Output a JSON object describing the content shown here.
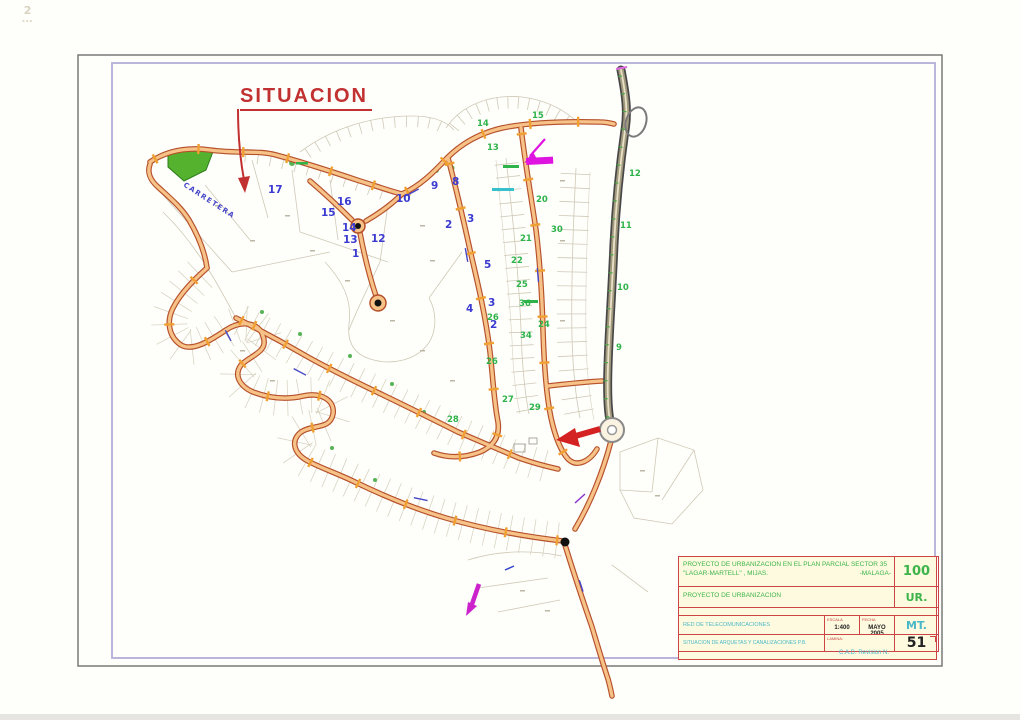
{
  "page": {
    "corner_mark": "2"
  },
  "situacion_label": "SITUACION",
  "map": {
    "road_name": "CARRETERA",
    "blue_labels": [
      {
        "t": "17",
        "x": 268,
        "y": 193
      },
      {
        "t": "16",
        "x": 337,
        "y": 205
      },
      {
        "t": "15",
        "x": 321,
        "y": 216
      },
      {
        "t": "14",
        "x": 342,
        "y": 231
      },
      {
        "t": "13",
        "x": 343,
        "y": 243
      },
      {
        "t": "12",
        "x": 371,
        "y": 242
      },
      {
        "t": "1",
        "x": 352,
        "y": 257
      },
      {
        "t": "10",
        "x": 396,
        "y": 202
      },
      {
        "t": "9",
        "x": 431,
        "y": 189
      },
      {
        "t": "8",
        "x": 452,
        "y": 185
      },
      {
        "t": "2",
        "x": 445,
        "y": 228
      },
      {
        "t": "3",
        "x": 467,
        "y": 222
      },
      {
        "t": "5",
        "x": 484,
        "y": 268
      },
      {
        "t": "4",
        "x": 466,
        "y": 312
      },
      {
        "t": "3",
        "x": 488,
        "y": 306
      },
      {
        "t": "2",
        "x": 490,
        "y": 328
      }
    ],
    "green_labels": [
      {
        "t": "12",
        "x": 629,
        "y": 176
      },
      {
        "t": "11",
        "x": 620,
        "y": 228
      },
      {
        "t": "10",
        "x": 617,
        "y": 290
      },
      {
        "t": "9",
        "x": 616,
        "y": 350
      },
      {
        "t": "14",
        "x": 477,
        "y": 126
      },
      {
        "t": "15",
        "x": 532,
        "y": 118
      },
      {
        "t": "13",
        "x": 487,
        "y": 150
      },
      {
        "t": "20",
        "x": 536,
        "y": 202
      },
      {
        "t": "21",
        "x": 520,
        "y": 241
      },
      {
        "t": "30",
        "x": 551,
        "y": 232
      },
      {
        "t": "22",
        "x": 511,
        "y": 263
      },
      {
        "t": "25",
        "x": 516,
        "y": 287
      },
      {
        "t": "24",
        "x": 538,
        "y": 327
      },
      {
        "t": "26",
        "x": 487,
        "y": 320
      },
      {
        "t": "34",
        "x": 520,
        "y": 338
      },
      {
        "t": "26",
        "x": 486,
        "y": 364
      },
      {
        "t": "36",
        "x": 519,
        "y": 306
      },
      {
        "t": "27",
        "x": 502,
        "y": 402
      },
      {
        "t": "29",
        "x": 529,
        "y": 410
      },
      {
        "t": "28",
        "x": 447,
        "y": 422
      }
    ]
  },
  "title_block": {
    "project_line1": "PROYECTO DE URBANIZACION EN EL PLAN PARCIAL SECTOR 35",
    "project_line2": "\"LAGAR-MARTELL\" , MIJAS.",
    "project_line2_right": "-MALAGA-",
    "subtitle": "PROYECTO DE URBANIZACION",
    "row3_text": "RED DE TELECOMUNICACIONES",
    "row4_text": "SITUACION DE ARQUETAS Y CANALIZACIONES P.B.",
    "escala_label": "ESCALA",
    "escala_value": "1:400",
    "fecha_label": "FECHA",
    "fecha_value": "MAYO 2005",
    "lamina_label": "LAMINA:",
    "code_top": "100",
    "code_ur": "UR.",
    "code_mt": "MT.",
    "sheet": "51",
    "cad_note": "C.A.D. Revision N."
  },
  "colors": {
    "accent_red": "#c23131",
    "road_fill": "#f6c287",
    "road_casing": "#b5502a",
    "label_blue": "#3b3bd1",
    "label_green": "#2eb34a",
    "cyan": "#4ab8c8",
    "magenta": "#e014e0"
  }
}
